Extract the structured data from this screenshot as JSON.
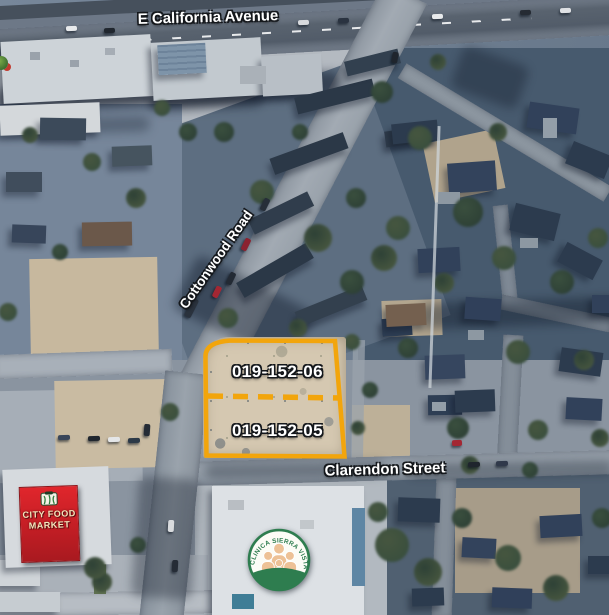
{
  "map": {
    "street_labels": {
      "california": "E California Avenue",
      "cottonwood": "Cottonwood Road",
      "clarendon": "Clarendon Street"
    },
    "parcel": {
      "north_id": "019-152-06",
      "south_id": "019-152-05",
      "outline_color": "#F2A50C"
    },
    "market_sign": {
      "line1": "CITY FOOD",
      "line2": "MARKET",
      "bg_color": "#D42127"
    },
    "clinic_logo": {
      "name": "CLINICA SIERRA VISTA",
      "green": "#2E7D4F"
    }
  }
}
